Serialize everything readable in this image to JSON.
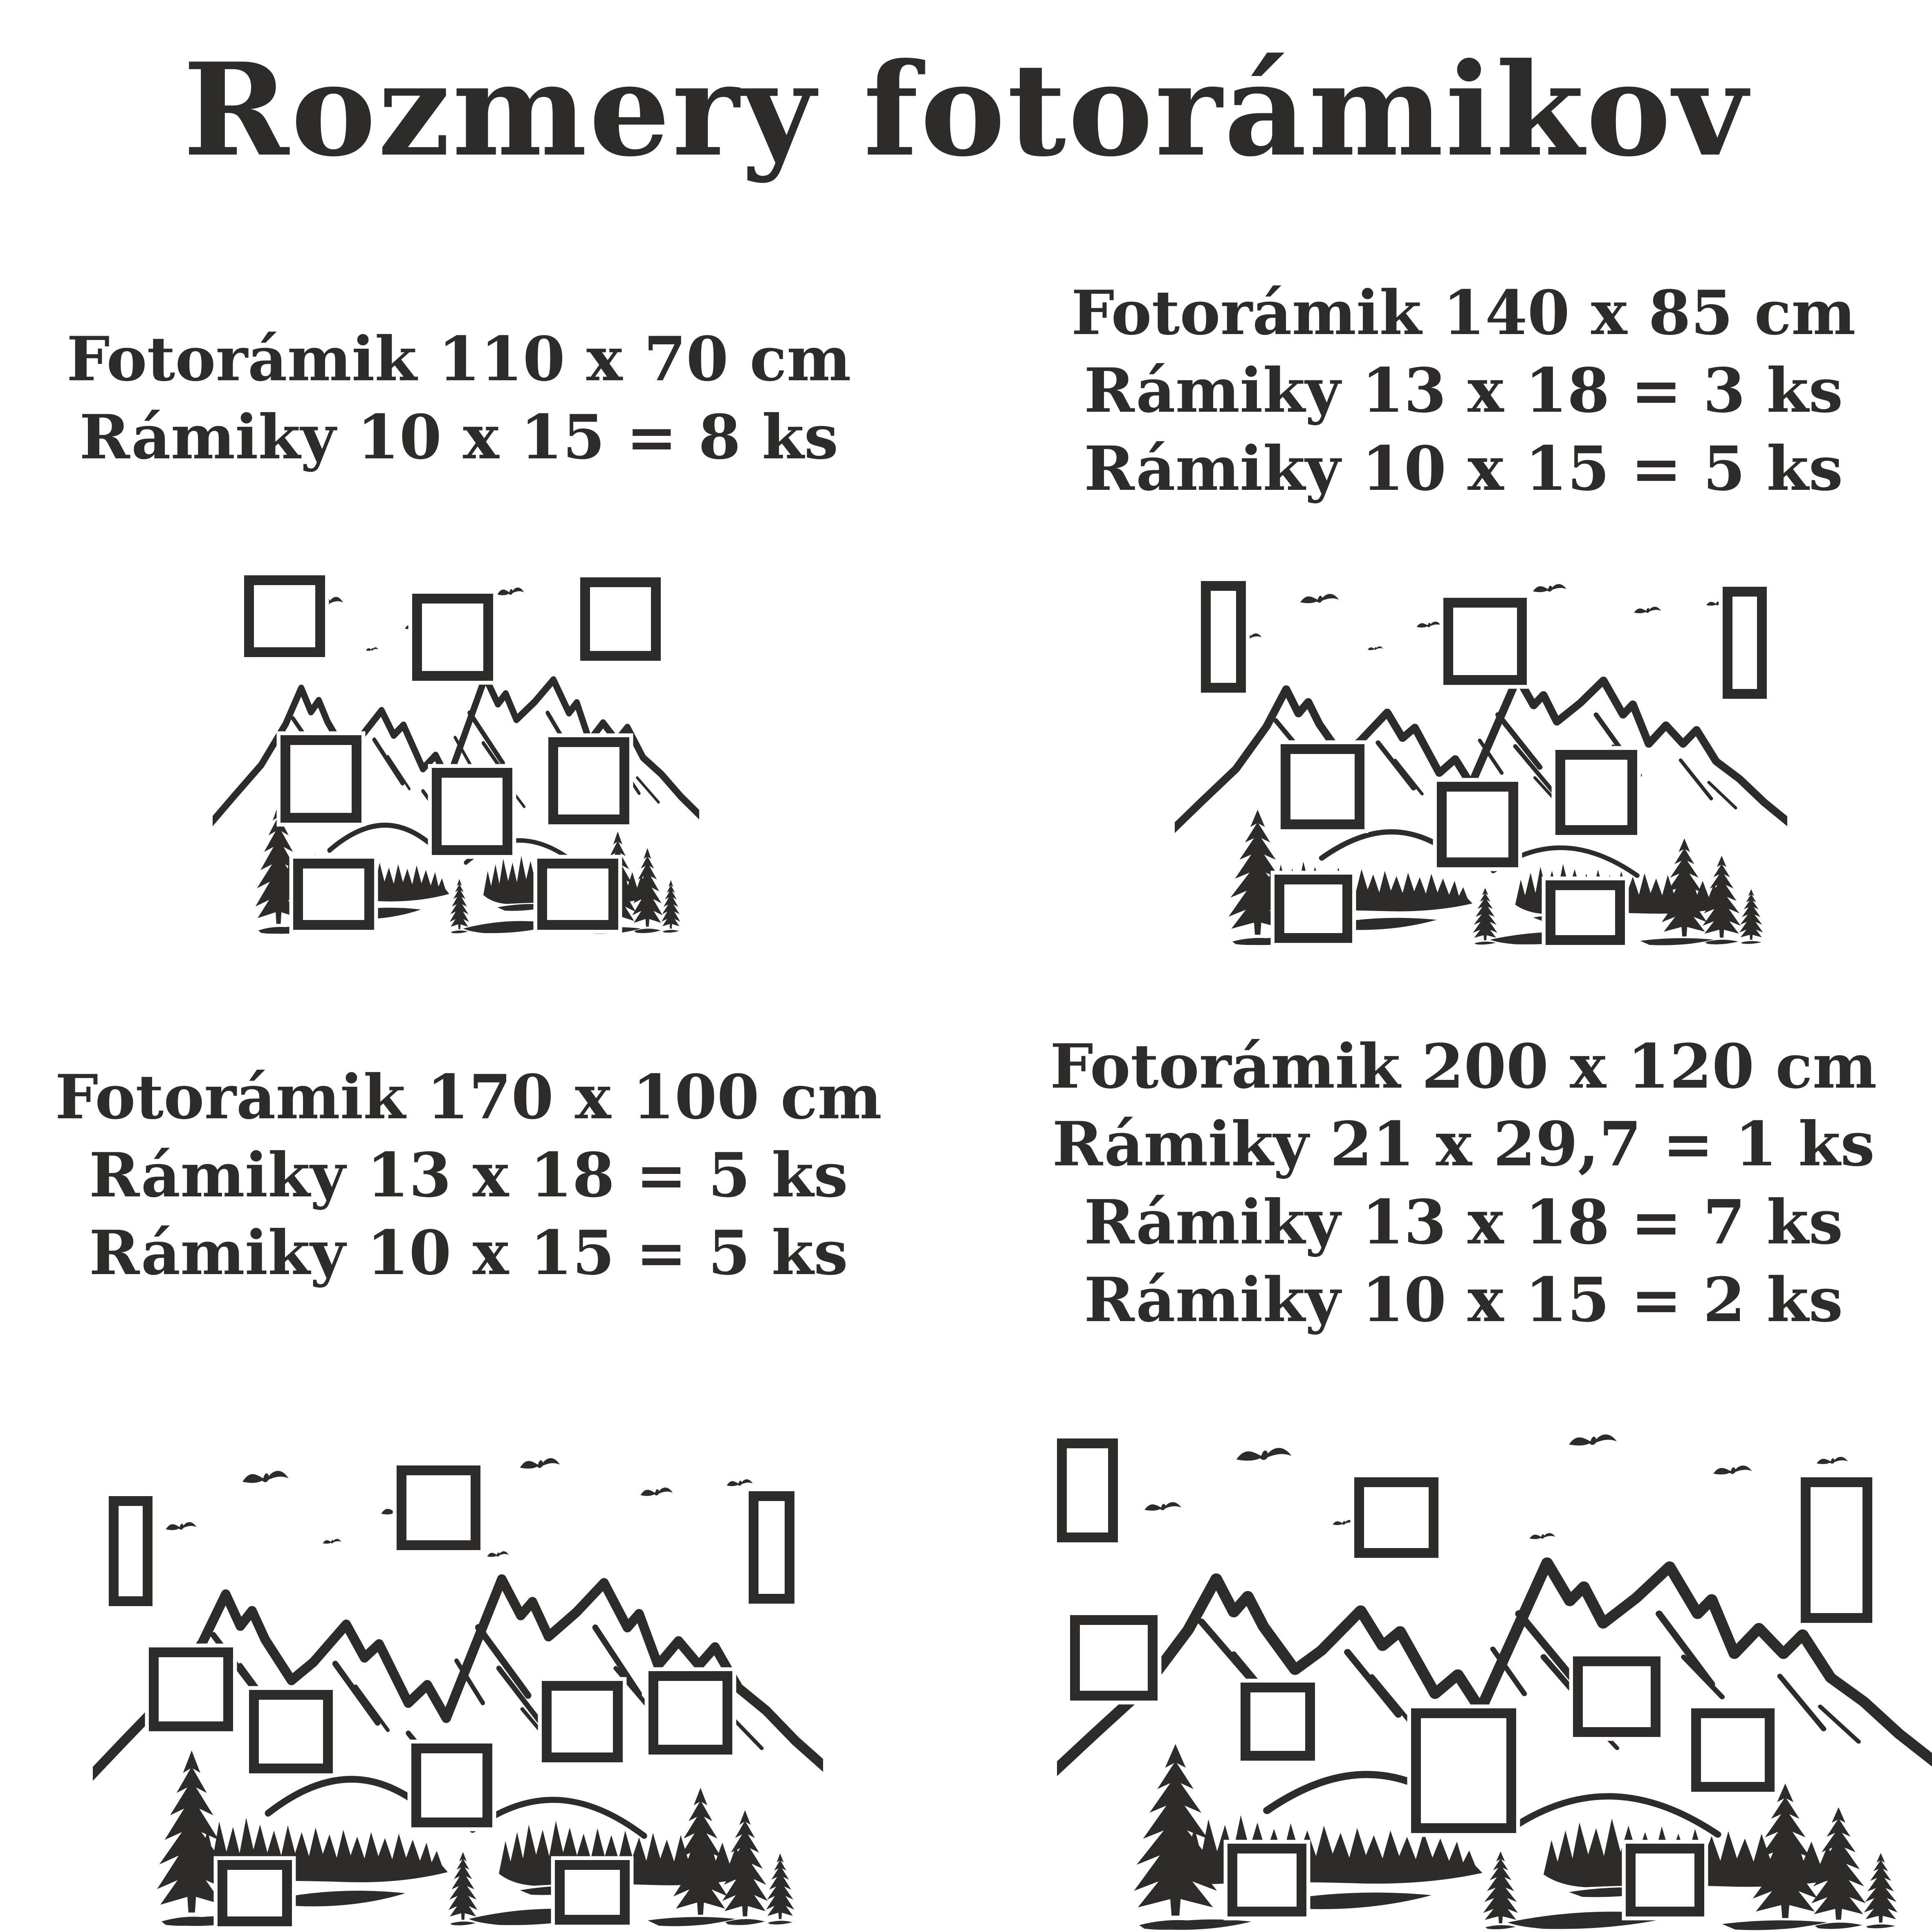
{
  "title": "Rozmery fotorámikov",
  "ink_color": "#2d2c2a",
  "background_color": "#ffffff",
  "quadrants": [
    {
      "id": "110x70",
      "lines": [
        "Fotorámik 110 x 70 cm",
        "Rámiky 10 x 15 = 8 ks"
      ],
      "frames": [
        {
          "x": 6.5,
          "y": 1,
          "w": 16.6,
          "h": 22.5
        },
        {
          "x": 41,
          "y": 6,
          "w": 16.6,
          "h": 24
        },
        {
          "x": 75.5,
          "y": 1.5,
          "w": 16.6,
          "h": 23
        },
        {
          "x": 14,
          "y": 45,
          "w": 16.6,
          "h": 24
        },
        {
          "x": 45,
          "y": 54,
          "w": 16.6,
          "h": 24
        },
        {
          "x": 69,
          "y": 45.5,
          "w": 16.6,
          "h": 24
        },
        {
          "x": 16.6,
          "y": 79,
          "w": 16.6,
          "h": 19.5
        },
        {
          "x": 66.7,
          "y": 79,
          "w": 16.6,
          "h": 19.5
        }
      ]
    },
    {
      "id": "140x85",
      "lines": [
        "Fotorámik 140 x 85 cm",
        "Rámiky 13 x 18 = 3 ks",
        "Rámiky 10 x 15 = 5 ks"
      ],
      "frames": [
        {
          "x": 4.3,
          "y": 3.4,
          "w": 7.3,
          "h": 29.5
        },
        {
          "x": 43.9,
          "y": 7.9,
          "w": 13.6,
          "h": 23
        },
        {
          "x": 89.5,
          "y": 5,
          "w": 7.2,
          "h": 29.5
        },
        {
          "x": 17.3,
          "y": 46.5,
          "w": 13.7,
          "h": 22.5
        },
        {
          "x": 42.8,
          "y": 56.5,
          "w": 13.3,
          "h": 22.5
        },
        {
          "x": 62.2,
          "y": 48,
          "w": 13.3,
          "h": 22.5
        },
        {
          "x": 16.3,
          "y": 81,
          "w": 12.7,
          "h": 18
        },
        {
          "x": 60.6,
          "y": 82.5,
          "w": 12.9,
          "h": 17
        }
      ]
    },
    {
      "id": "170x100",
      "lines": [
        "Fotorámik 170 x 100 cm",
        "Rámiky 13 x 18 = 5 ks",
        "Rámiky 10 x 15 = 5 ks"
      ],
      "frames": [
        {
          "x": 2.2,
          "y": 12,
          "w": 6,
          "h": 22.4
        },
        {
          "x": 41.6,
          "y": 5.7,
          "w": 11.5,
          "h": 17.3
        },
        {
          "x": 89.8,
          "y": 11,
          "w": 6.3,
          "h": 22.9
        },
        {
          "x": 7.7,
          "y": 42.8,
          "w": 11.5,
          "h": 17.1
        },
        {
          "x": 21.4,
          "y": 51.5,
          "w": 11.5,
          "h": 17
        },
        {
          "x": 43.6,
          "y": 62.4,
          "w": 11.1,
          "h": 17.1
        },
        {
          "x": 61.5,
          "y": 49.6,
          "w": 11.1,
          "h": 16.6
        },
        {
          "x": 76.1,
          "y": 47.6,
          "w": 11.5,
          "h": 17
        },
        {
          "x": 17.1,
          "y": 86.1,
          "w": 10.2,
          "h": 13.5
        },
        {
          "x": 63.3,
          "y": 86.1,
          "w": 10.2,
          "h": 13.2
        }
      ]
    },
    {
      "id": "200x120",
      "lines": [
        "Fotorámik 200 x 120 cm",
        "Rámiky 21 x 29,7 = 1 ks",
        "Rámiky 13 x 18 = 7 ks",
        "Rámiky 10 x 15 = 2 ks"
      ],
      "frames": [
        {
          "x": 0,
          "y": 5,
          "w": 7,
          "h": 20
        },
        {
          "x": 1.5,
          "y": 39,
          "w": 10,
          "h": 16.5
        },
        {
          "x": 34,
          "y": 12.5,
          "w": 9.6,
          "h": 15.5
        },
        {
          "x": 85,
          "y": 12.5,
          "w": 8.2,
          "h": 28
        },
        {
          "x": 21,
          "y": 52,
          "w": 8.5,
          "h": 15
        },
        {
          "x": 40.5,
          "y": 57,
          "w": 12,
          "h": 24
        },
        {
          "x": 59,
          "y": 47,
          "w": 10,
          "h": 15.5
        },
        {
          "x": 72.5,
          "y": 57,
          "w": 9.5,
          "h": 16
        },
        {
          "x": 19.5,
          "y": 83,
          "w": 9,
          "h": 14
        },
        {
          "x": 65,
          "y": 83,
          "w": 9,
          "h": 14
        }
      ]
    }
  ]
}
